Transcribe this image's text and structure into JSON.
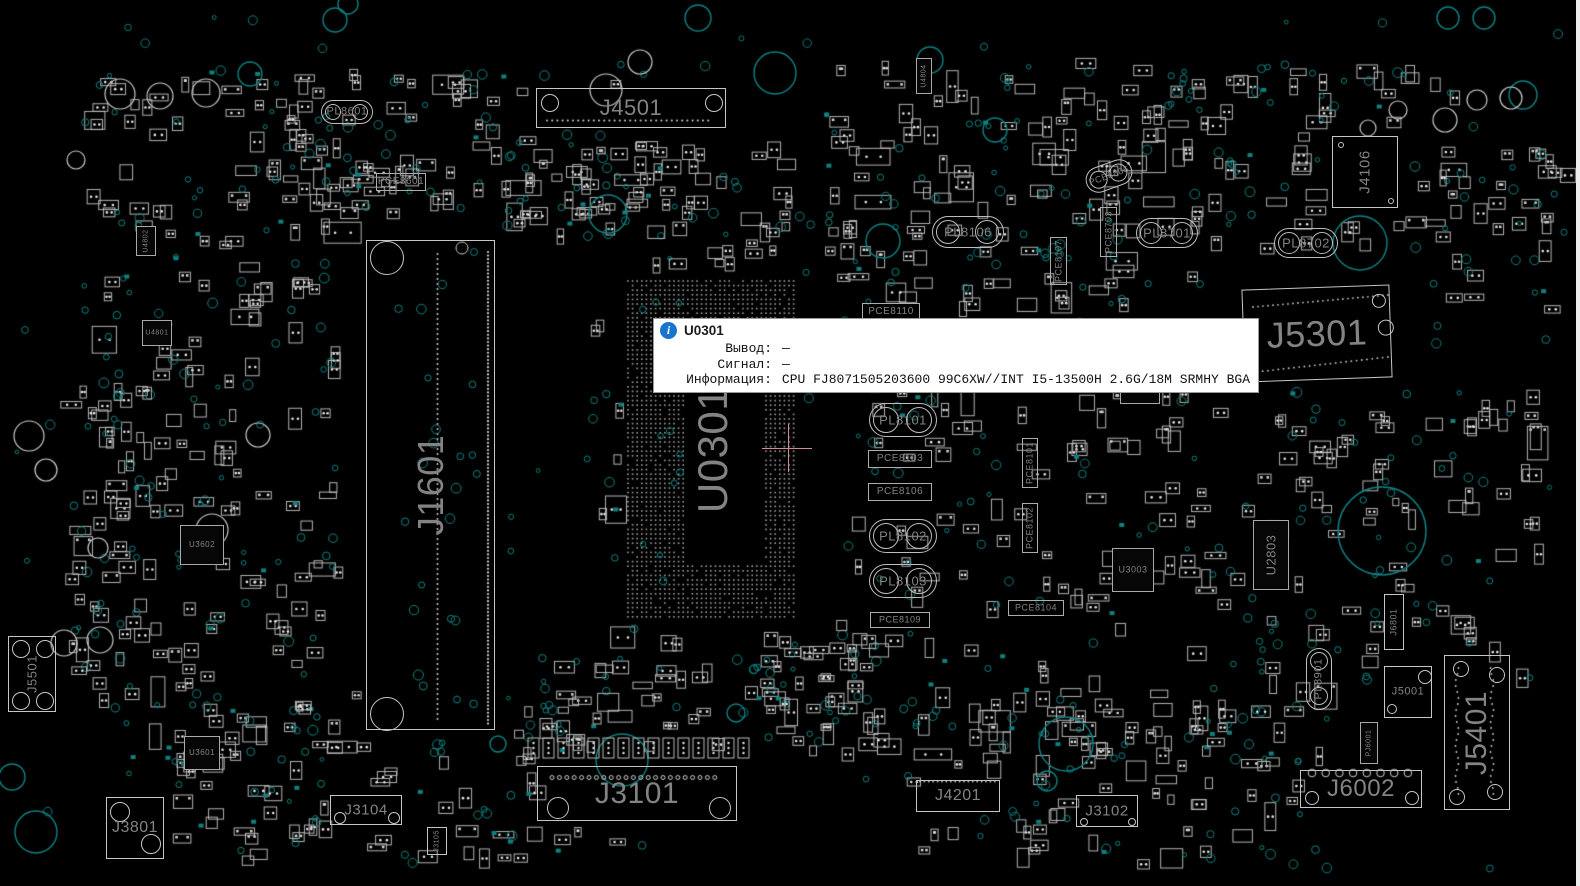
{
  "app": {
    "kind": "pcb-boardview-viewer"
  },
  "colors": {
    "background": "#000000",
    "outline": "#bdbdbd",
    "label_gray": "#838383",
    "via_teal": "#0e8383",
    "pad_white": "#e0e0e0",
    "highlight_pink": "#cf8d8d",
    "tooltip_bg": "#ffffff",
    "info_blue": "#1874cd",
    "edge_strip": "#ededed"
  },
  "tooltip": {
    "ref": "U0301",
    "icon": "info-icon",
    "rows": [
      {
        "label": "Вывод:",
        "value": "—"
      },
      {
        "label": "Сигнал:",
        "value": "—"
      },
      {
        "label": "Информация:",
        "value": "CPU FJ8071505203600 99C6XW//INT I5-13500H 2.6G/18M SRMHY BGA"
      }
    ]
  },
  "crosshair": {
    "x": 788,
    "y": 448
  },
  "board": {
    "components": [
      {
        "ref": "J4501",
        "type": "conn",
        "x": 536,
        "y": 88,
        "w": 190,
        "h": 40,
        "fs": 22,
        "holes": [
          [
            13,
            14,
            9
          ],
          [
            177,
            14,
            9
          ]
        ]
      },
      {
        "ref": "J3101",
        "type": "conn",
        "x": 537,
        "y": 766,
        "w": 200,
        "h": 55,
        "fs": 30,
        "holes": [
          [
            20,
            41,
            11
          ],
          [
            182,
            41,
            11
          ]
        ]
      },
      {
        "ref": "J1601",
        "type": "conn",
        "x": 366,
        "y": 240,
        "w": 129,
        "h": 490,
        "fs": 36,
        "rot": -90,
        "holes": [
          [
            20,
            17,
            17
          ],
          [
            20,
            473,
            17
          ]
        ]
      },
      {
        "ref": "J5301",
        "type": "conn",
        "x": 1243,
        "y": 287,
        "w": 148,
        "h": 93,
        "fs": 36,
        "tilt": -2,
        "holes": [
          [
            136,
            15,
            7
          ],
          [
            142,
            42,
            8
          ]
        ]
      },
      {
        "ref": "J5401",
        "type": "conn",
        "x": 1444,
        "y": 655,
        "w": 66,
        "h": 155,
        "fs": 30,
        "rot": -90,
        "holes": [
          [
            16,
            13,
            8
          ],
          [
            52,
            19,
            8
          ],
          [
            12,
            141,
            8
          ],
          [
            50,
            136,
            8
          ]
        ]
      },
      {
        "ref": "J6002",
        "type": "conn",
        "x": 1300,
        "y": 770,
        "w": 122,
        "h": 38,
        "fs": 24,
        "holes": [
          [
            11,
            27,
            7
          ],
          [
            111,
            27,
            7
          ]
        ]
      },
      {
        "ref": "J3801",
        "type": "conn",
        "x": 106,
        "y": 797,
        "w": 58,
        "h": 62,
        "fs": 16,
        "holes": [
          [
            13,
            14,
            10
          ],
          [
            44,
            46,
            10
          ]
        ]
      },
      {
        "ref": "J3104",
        "type": "conn",
        "x": 330,
        "y": 795,
        "w": 72,
        "h": 30,
        "fs": 15,
        "holes": [
          [
            9,
            22,
            6
          ],
          [
            63,
            22,
            6
          ]
        ]
      },
      {
        "ref": "J4201",
        "type": "conn",
        "x": 916,
        "y": 780,
        "w": 84,
        "h": 32,
        "fs": 16
      },
      {
        "ref": "J3102",
        "type": "conn",
        "x": 1076,
        "y": 795,
        "w": 62,
        "h": 32,
        "fs": 15,
        "holes": [
          [
            7,
            26,
            4
          ],
          [
            55,
            26,
            4
          ]
        ]
      },
      {
        "ref": "J5501",
        "type": "conn",
        "x": 8,
        "y": 636,
        "w": 48,
        "h": 76,
        "fs": 13,
        "rot": -90,
        "holes": [
          [
            12,
            12,
            9
          ],
          [
            36,
            12,
            9
          ],
          [
            12,
            64,
            9
          ],
          [
            36,
            64,
            9
          ]
        ]
      },
      {
        "ref": "J5001",
        "type": "conn",
        "x": 1384,
        "y": 666,
        "w": 48,
        "h": 52,
        "fs": 11,
        "holes": [
          [
            40,
            10,
            7
          ],
          [
            7,
            42,
            5
          ]
        ]
      },
      {
        "ref": "J6801",
        "type": "conn",
        "x": 1384,
        "y": 594,
        "w": 20,
        "h": 56,
        "fs": 9,
        "rot": -90
      },
      {
        "ref": "J4106",
        "type": "conn",
        "x": 1332,
        "y": 136,
        "w": 66,
        "h": 72,
        "fs": 15,
        "rot": -90,
        "holes": [
          [
            8,
            8,
            3
          ],
          [
            58,
            64,
            3
          ]
        ]
      },
      {
        "ref": "J3105",
        "type": "conn",
        "x": 427,
        "y": 827,
        "w": 20,
        "h": 28,
        "fs": 7,
        "rot": -90
      },
      {
        "ref": "PL8601",
        "type": "ind",
        "x": 321,
        "y": 100,
        "w": 52,
        "h": 24,
        "fs": 11
      },
      {
        "ref": "PL8701",
        "type": "ind",
        "x": 1136,
        "y": 218,
        "w": 62,
        "h": 30,
        "fs": 13
      },
      {
        "ref": "PL8702",
        "type": "ind",
        "x": 1274,
        "y": 228,
        "w": 64,
        "h": 30,
        "fs": 13
      },
      {
        "ref": "PL8106",
        "type": "ind",
        "x": 932,
        "y": 216,
        "w": 72,
        "h": 32,
        "fs": 13
      },
      {
        "ref": "PL8101",
        "type": "ind",
        "x": 869,
        "y": 403,
        "w": 68,
        "h": 34,
        "fs": 13
      },
      {
        "ref": "PL8102",
        "type": "ind",
        "x": 869,
        "y": 519,
        "w": 68,
        "h": 34,
        "fs": 13
      },
      {
        "ref": "PL8103",
        "type": "ind",
        "x": 869,
        "y": 564,
        "w": 68,
        "h": 34,
        "fs": 13
      },
      {
        "ref": "PL8901",
        "type": "ind",
        "x": 1306,
        "y": 648,
        "w": 26,
        "h": 62,
        "fs": 11,
        "rot": -90
      },
      {
        "ref": "PCE8806",
        "type": "ind",
        "x": 1085,
        "y": 163,
        "w": 48,
        "h": 26,
        "fs": 9,
        "tilt": -20
      },
      {
        "ref": "PCE8601",
        "type": "cap",
        "x": 376,
        "y": 173,
        "w": 50,
        "h": 18,
        "fs": 10
      },
      {
        "ref": "PCE8110",
        "type": "cap",
        "x": 862,
        "y": 303,
        "w": 58,
        "h": 18,
        "fs": 10
      },
      {
        "ref": "PCE8103",
        "type": "cap",
        "x": 868,
        "y": 450,
        "w": 64,
        "h": 18,
        "fs": 10
      },
      {
        "ref": "PCE8106",
        "type": "cap",
        "x": 868,
        "y": 483,
        "w": 64,
        "h": 18,
        "fs": 10
      },
      {
        "ref": "PCE8109",
        "type": "cap",
        "x": 870,
        "y": 612,
        "w": 60,
        "h": 16,
        "fs": 9
      },
      {
        "ref": "PCE8104",
        "type": "cap",
        "x": 1008,
        "y": 600,
        "w": 56,
        "h": 16,
        "fs": 9
      },
      {
        "ref": "PCE8101",
        "type": "cap",
        "x": 1022,
        "y": 438,
        "w": 16,
        "h": 50,
        "fs": 9,
        "rot": -90
      },
      {
        "ref": "PCE8102",
        "type": "cap",
        "x": 1022,
        "y": 503,
        "w": 16,
        "h": 50,
        "fs": 9,
        "rot": -90
      },
      {
        "ref": "PCE8107",
        "type": "cap",
        "x": 1050,
        "y": 237,
        "w": 17,
        "h": 48,
        "fs": 9,
        "rot": -90
      },
      {
        "ref": "PCE8703",
        "type": "cap",
        "x": 1100,
        "y": 207,
        "w": 17,
        "h": 50,
        "fs": 9,
        "rot": -90
      },
      {
        "ref": "U0301",
        "type": "bga",
        "x": 625,
        "y": 278,
        "w": 175,
        "h": 344,
        "fs": 42,
        "rot": -90
      },
      {
        "ref": "U3602",
        "type": "chip",
        "x": 180,
        "y": 525,
        "w": 44,
        "h": 40,
        "fs": 8
      },
      {
        "ref": "U3601",
        "type": "chip",
        "x": 184,
        "y": 736,
        "w": 36,
        "h": 34,
        "fs": 8
      },
      {
        "ref": "U2803",
        "type": "chip",
        "x": 1253,
        "y": 520,
        "w": 36,
        "h": 70,
        "fs": 13,
        "rot": -90
      },
      {
        "ref": "U3003",
        "type": "chip",
        "x": 1112,
        "y": 548,
        "w": 42,
        "h": 44,
        "fs": 9
      },
      {
        "ref": "U4804",
        "type": "chip",
        "x": 916,
        "y": 58,
        "w": 16,
        "h": 36,
        "fs": 7,
        "rot": -90
      },
      {
        "ref": "PU8001",
        "type": "chip",
        "x": 1120,
        "y": 378,
        "w": 40,
        "h": 26,
        "fs": 8
      },
      {
        "ref": "PJ6001",
        "type": "chip",
        "x": 1360,
        "y": 722,
        "w": 18,
        "h": 42,
        "fs": 7,
        "rot": -90
      },
      {
        "ref": "U4802",
        "type": "chip",
        "x": 136,
        "y": 226,
        "w": 20,
        "h": 30,
        "fs": 7,
        "rot": -90
      },
      {
        "ref": "U4801",
        "type": "chip",
        "x": 142,
        "y": 320,
        "w": 30,
        "h": 26,
        "fs": 7
      }
    ],
    "big_circles_teal": [
      [
        608,
        214,
        19
      ],
      [
        622,
        760,
        26
      ],
      [
        883,
        241,
        17
      ],
      [
        1066,
        744,
        27
      ],
      [
        1382,
        531,
        44
      ],
      [
        775,
        73,
        21
      ],
      [
        1523,
        95,
        14
      ],
      [
        36,
        832,
        21
      ],
      [
        12,
        777,
        13
      ],
      [
        335,
        20,
        12
      ],
      [
        250,
        74,
        12
      ],
      [
        930,
        60,
        13
      ],
      [
        995,
        130,
        12
      ],
      [
        1360,
        243,
        27
      ],
      [
        1047,
        781,
        10
      ],
      [
        736,
        713,
        9
      ],
      [
        498,
        744,
        8
      ],
      [
        1448,
        18,
        11
      ],
      [
        1484,
        18,
        11
      ],
      [
        698,
        18,
        13
      ],
      [
        348,
        4,
        10
      ]
    ],
    "big_circles_white": [
      [
        120,
        94,
        15
      ],
      [
        160,
        96,
        13
      ],
      [
        206,
        93,
        14
      ],
      [
        76,
        160,
        9
      ],
      [
        1445,
        120,
        12
      ],
      [
        1477,
        100,
        10
      ],
      [
        1511,
        98,
        11
      ],
      [
        64,
        643,
        13
      ],
      [
        100,
        640,
        13
      ],
      [
        29,
        436,
        15
      ],
      [
        46,
        470,
        11
      ],
      [
        258,
        435,
        12
      ],
      [
        606,
        90,
        16
      ],
      [
        640,
        62,
        12
      ],
      [
        1368,
        128,
        8
      ],
      [
        1398,
        110,
        9
      ],
      [
        212,
        530,
        16
      ],
      [
        98,
        548,
        10
      ]
    ]
  }
}
